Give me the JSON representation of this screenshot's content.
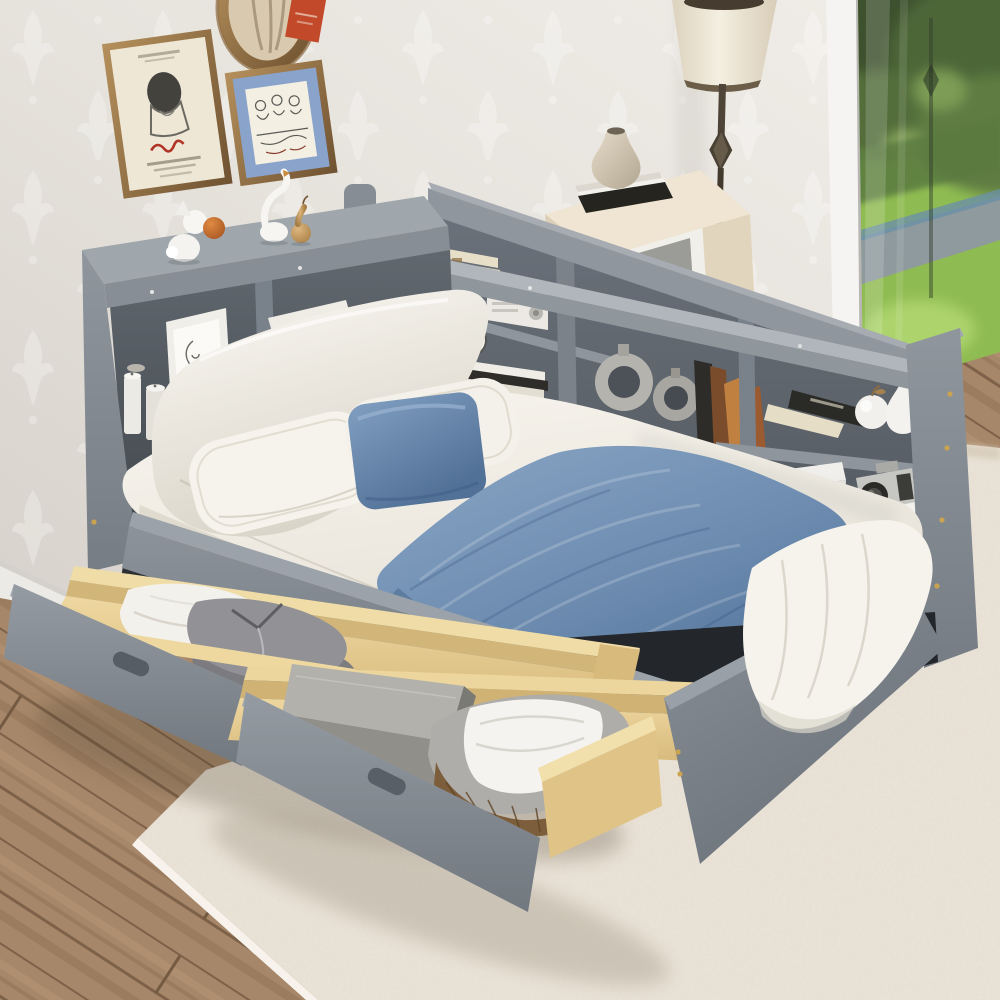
{
  "image": {
    "kind": "product-photograph",
    "room": "bedroom",
    "subject": "gray wooden daybed with L-shaped bookcase storage headboard and two pulled-out under-bed storage drawers",
    "setting": "bright bedroom with damask wallpaper, floor-to-ceiling window to a garden, wood plank floor and a pale area rug"
  },
  "palette": {
    "wall": "#e6e2dc",
    "wallpaper_motif": "#f6f4f0",
    "bed_frame_gray": "#868d94",
    "bed_frame_light": "#a2a9af",
    "bed_frame_dark": "#565d64",
    "drawer_wood": "#e6cf97",
    "bedding_white": "#f4f1ea",
    "accent_blue": "#6e8cae",
    "blanket_blue_dark": "#54749a",
    "window_trees": "#45582f",
    "window_grass": "#96c158",
    "garden_path": "#8e9a9d",
    "wood_floor": "#a68769",
    "rug": "#eae3d8",
    "gold_hardware": "#c9a351",
    "lamp_shade": "#f1ead9",
    "dresser_cream": "#efe5d2",
    "frame_gold": "#9c7a4c",
    "poster_red_signature": "#b03527",
    "mat_blue": "#8aa3cb",
    "basket_wicker": "#7d5e3c"
  },
  "objects": {
    "wall_art": [
      "framed portrait poster with red signature",
      "gold oval frame",
      "small orange card",
      "gold frame with blue mat figure sketch"
    ],
    "floor_lamp": "cream tapered-shade floor lamp with dark bronze pole and diamond ornament",
    "dresser": "cream sideboard topped with stone vase, white and black books, leaning picture frame",
    "window_view": [
      "blurred trees",
      "sunlit lawn",
      "diagonal gray garden path"
    ],
    "rail_figurines": [
      "white rabbit figurine",
      "orange ball",
      "white swan figurine",
      "gold pear figurine"
    ],
    "side_shelf_contents": [
      "framed line-art face",
      "white pillar candles",
      "stacked white books"
    ],
    "head_shelf_contents": [
      "stacked cream books",
      "white vintage radio",
      "round clock",
      "stacked magazines",
      "two silver ring vases",
      "leaning books",
      "white ceramic apple",
      "white ceramic pear",
      "white stereo",
      "camera on white book",
      "upright books"
    ],
    "bedding": [
      "large white backrest pillow",
      "two white pillows",
      "blue chenille cushion",
      "blue chenille blanket",
      "white sheet drape at foot"
    ],
    "drawer_1_contents": [
      "folded white cloth",
      "folded gray sweaters"
    ],
    "drawer_2_contents": [
      "gray storage box",
      "wicker basket with gray liner and white linen"
    ]
  }
}
